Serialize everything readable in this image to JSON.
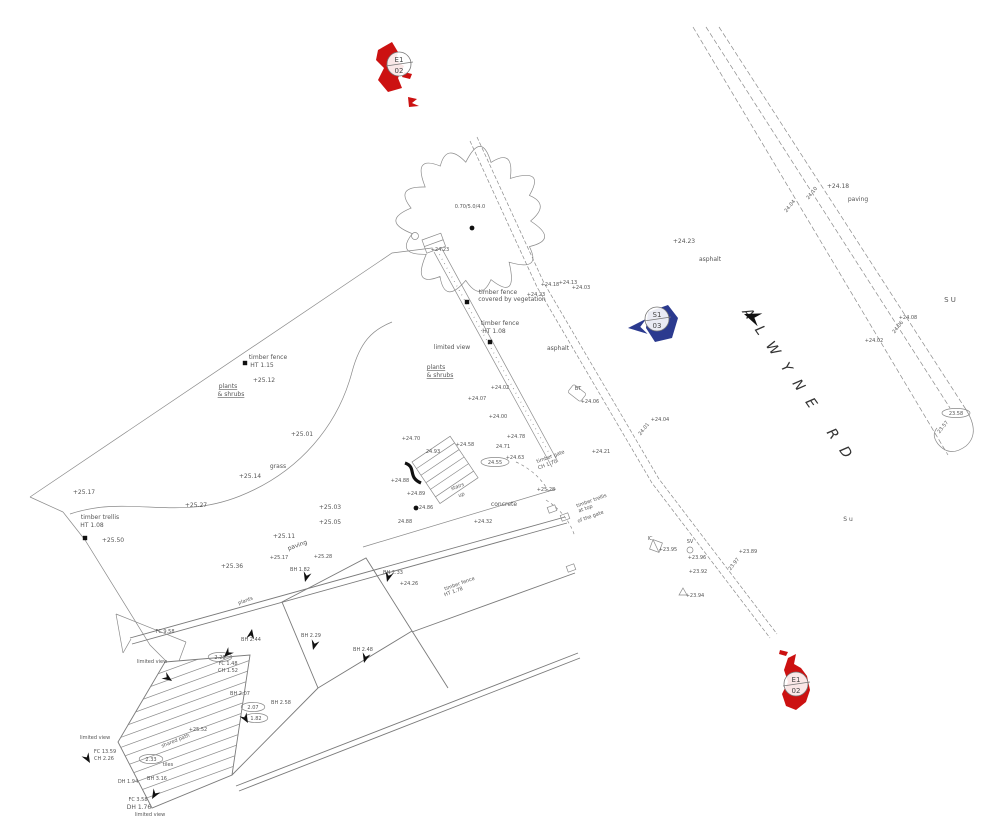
{
  "colors": {
    "station_red": "#cc1111",
    "station_blue": "#2b3a8f",
    "line": "#8a8a8a",
    "text": "#555555"
  },
  "road": {
    "name": "ALWYNE RD"
  },
  "tree": {
    "label": "0.70/5.0/4.0"
  },
  "markers": [
    {
      "id": "station-E1-02-top",
      "line1": "E1",
      "line2": "02",
      "color": "#cc1111",
      "cx": 399,
      "cy": 64
    },
    {
      "id": "station-S1-03",
      "line1": "S1",
      "line2": "03",
      "color": "#2b3a8f",
      "cx": 657,
      "cy": 319
    },
    {
      "id": "station-E1-02-bottom",
      "line1": "E1",
      "line2": "02",
      "color": "#cc1111",
      "cx": 796,
      "cy": 684
    }
  ],
  "ovals": [
    {
      "t": "2.28",
      "x": 220,
      "y": 657
    },
    {
      "t": "2.07",
      "x": 253,
      "y": 707
    },
    {
      "t": "1.82",
      "x": 256,
      "y": 718
    },
    {
      "t": "2.33",
      "x": 151,
      "y": 759
    },
    {
      "t": "24.55",
      "x": 495,
      "y": 462
    },
    {
      "t": "23.58",
      "x": 956,
      "y": 413
    }
  ],
  "posts": [
    {
      "x": 467,
      "y": 302
    },
    {
      "x": 490,
      "y": 342
    },
    {
      "x": 85,
      "y": 538
    },
    {
      "x": 245,
      "y": 363
    }
  ],
  "dots": [
    {
      "x": 416,
      "y": 508
    },
    {
      "x": 472,
      "y": 228
    }
  ],
  "arrows": [
    {
      "x": 252,
      "y": 629,
      "r": -80
    },
    {
      "x": 305,
      "y": 582,
      "r": 105
    },
    {
      "x": 313,
      "y": 650,
      "r": 105
    },
    {
      "x": 364,
      "y": 663,
      "r": 105
    },
    {
      "x": 387,
      "y": 582,
      "r": 105
    },
    {
      "x": 172,
      "y": 681,
      "r": 35
    },
    {
      "x": 224,
      "y": 657,
      "r": 135
    },
    {
      "x": 248,
      "y": 723,
      "r": 60
    },
    {
      "x": 152,
      "y": 799,
      "r": 120
    },
    {
      "x": 90,
      "y": 763,
      "r": 60
    },
    {
      "x": 744,
      "y": 314,
      "r": 200,
      "s": 1.7
    },
    {
      "x": 628,
      "y": 328,
      "r": 175,
      "s": 1.9,
      "c": "#2b3a8f"
    }
  ],
  "labels": [
    {
      "t": "+25.17",
      "x": 84,
      "y": 494
    },
    {
      "t": "+25.27",
      "x": 196,
      "y": 507
    },
    {
      "t": "timber trellis",
      "x": 100,
      "y": 519
    },
    {
      "t": "HT 1.08",
      "x": 92,
      "y": 527
    },
    {
      "t": "+25.50",
      "x": 113,
      "y": 542
    },
    {
      "t": "+25.36",
      "x": 232,
      "y": 568
    },
    {
      "t": "timber fence",
      "x": 268,
      "y": 359
    },
    {
      "t": "HT 1.15",
      "x": 262,
      "y": 367
    },
    {
      "t": "+25.12",
      "x": 264,
      "y": 382
    },
    {
      "t": "plants",
      "x": 228,
      "y": 388,
      "u": 1
    },
    {
      "t": "& shrubs",
      "x": 231,
      "y": 396,
      "u": 1
    },
    {
      "t": "grass",
      "x": 278,
      "y": 468
    },
    {
      "t": "+25.14",
      "x": 250,
      "y": 478
    },
    {
      "t": "+25.01",
      "x": 302,
      "y": 436
    },
    {
      "t": "+25.11",
      "x": 284,
      "y": 538
    },
    {
      "t": "+25.03",
      "x": 330,
      "y": 509
    },
    {
      "t": "+25.05",
      "x": 330,
      "y": 524
    },
    {
      "t": "+24.23",
      "x": 440,
      "y": 251,
      "s": 5
    },
    {
      "t": "timber fence",
      "x": 498,
      "y": 294
    },
    {
      "t": "covered by vegetation",
      "x": 512,
      "y": 301
    },
    {
      "t": "+24.23",
      "x": 536,
      "y": 296,
      "s": 5
    },
    {
      "t": "+24.18",
      "x": 550,
      "y": 286,
      "s": 5
    },
    {
      "t": "+24.13",
      "x": 568,
      "y": 284,
      "s": 5
    },
    {
      "t": "+24.03",
      "x": 581,
      "y": 289,
      "s": 5
    },
    {
      "t": "timber fence",
      "x": 500,
      "y": 325
    },
    {
      "t": "HT 1.08",
      "x": 494,
      "y": 333
    },
    {
      "t": "limited view",
      "x": 452,
      "y": 349
    },
    {
      "t": "asphalt",
      "x": 558,
      "y": 350
    },
    {
      "t": "plants",
      "x": 436,
      "y": 369,
      "u": 1
    },
    {
      "t": "& shrubs",
      "x": 440,
      "y": 377,
      "u": 1
    },
    {
      "t": "+24.02",
      "x": 500,
      "y": 389,
      "s": 5
    },
    {
      "t": "+24.07",
      "x": 477,
      "y": 400,
      "s": 5
    },
    {
      "t": "+24.00",
      "x": 498,
      "y": 418,
      "s": 5
    },
    {
      "t": "+24.23",
      "x": 684,
      "y": 243
    },
    {
      "t": "asphalt",
      "x": 710,
      "y": 261
    },
    {
      "t": "+24.18",
      "x": 838,
      "y": 188
    },
    {
      "t": "paving",
      "x": 858,
      "y": 201
    },
    {
      "t": "24.10",
      "x": 813,
      "y": 194,
      "r": -52,
      "s": 5
    },
    {
      "t": "24.04",
      "x": 791,
      "y": 207,
      "r": -52,
      "s": 5
    },
    {
      "t": "+24.08",
      "x": 908,
      "y": 319,
      "s": 5
    },
    {
      "t": "24.06",
      "x": 899,
      "y": 328,
      "r": -52,
      "s": 5
    },
    {
      "t": "+24.02",
      "x": 874,
      "y": 342,
      "s": 5
    },
    {
      "t": "S U",
      "x": 950,
      "y": 302,
      "s": 7
    },
    {
      "t": "S u",
      "x": 848,
      "y": 521
    },
    {
      "t": "23.57",
      "x": 944,
      "y": 428,
      "r": -52,
      "s": 5
    },
    {
      "t": "BT",
      "x": 578,
      "y": 390,
      "s": 5
    },
    {
      "t": "+24.06",
      "x": 590,
      "y": 403,
      "s": 5
    },
    {
      "t": "+24.04",
      "x": 660,
      "y": 421,
      "s": 5
    },
    {
      "t": "24.01",
      "x": 645,
      "y": 430,
      "r": -52,
      "s": 5
    },
    {
      "t": "+24.21",
      "x": 601,
      "y": 453,
      "s": 5
    },
    {
      "t": "IC",
      "x": 650,
      "y": 540,
      "s": 5
    },
    {
      "t": "+23.95",
      "x": 668,
      "y": 551,
      "s": 5
    },
    {
      "t": "SV",
      "x": 690,
      "y": 543,
      "s": 5
    },
    {
      "t": "+23.96",
      "x": 697,
      "y": 559,
      "s": 5
    },
    {
      "t": "+23.89",
      "x": 748,
      "y": 553,
      "s": 5
    },
    {
      "t": "23.97",
      "x": 735,
      "y": 565,
      "r": -52,
      "s": 5
    },
    {
      "t": "+23.92",
      "x": 698,
      "y": 573,
      "s": 5
    },
    {
      "t": "+23.94",
      "x": 695,
      "y": 597,
      "s": 5
    },
    {
      "t": "+24.70",
      "x": 411,
      "y": 440,
      "s": 5
    },
    {
      "t": "+24.58",
      "x": 465,
      "y": 446,
      "s": 5
    },
    {
      "t": "24.93",
      "x": 433,
      "y": 453,
      "s": 5
    },
    {
      "t": "+24.78",
      "x": 516,
      "y": 438,
      "s": 5
    },
    {
      "t": "24.71",
      "x": 503,
      "y": 448,
      "s": 5
    },
    {
      "t": "+24.63",
      "x": 515,
      "y": 459,
      "s": 5
    },
    {
      "t": "timber gate",
      "x": 551,
      "y": 458,
      "r": -20,
      "s": 5
    },
    {
      "t": "CH 1.70",
      "x": 548,
      "y": 466,
      "r": -20,
      "s": 5
    },
    {
      "t": "stairs",
      "x": 458,
      "y": 488,
      "r": -20,
      "s": 5
    },
    {
      "t": "up",
      "x": 462,
      "y": 496,
      "r": -20,
      "s": 5
    },
    {
      "t": "+24.88",
      "x": 400,
      "y": 482,
      "s": 5
    },
    {
      "t": "+24.89",
      "x": 416,
      "y": 495,
      "s": 5
    },
    {
      "t": "+24.86",
      "x": 424,
      "y": 509,
      "s": 5
    },
    {
      "t": "24.88",
      "x": 405,
      "y": 523,
      "s": 5
    },
    {
      "t": "concrete",
      "x": 504,
      "y": 506
    },
    {
      "t": "+24.32",
      "x": 483,
      "y": 523,
      "s": 5
    },
    {
      "t": "+25.28",
      "x": 546,
      "y": 491,
      "s": 5
    },
    {
      "t": "timber trellis",
      "x": 592,
      "y": 502,
      "r": -20,
      "s": 5
    },
    {
      "t": "at top",
      "x": 586,
      "y": 510,
      "r": -20,
      "s": 5
    },
    {
      "t": "of the gate",
      "x": 591,
      "y": 518,
      "r": -20,
      "s": 5
    },
    {
      "t": "paving",
      "x": 298,
      "y": 547,
      "r": -20
    },
    {
      "t": "+25.17",
      "x": 279,
      "y": 559,
      "s": 5
    },
    {
      "t": "+25.28",
      "x": 323,
      "y": 558,
      "s": 5
    },
    {
      "t": "BH 1.82",
      "x": 300,
      "y": 571,
      "s": 5
    },
    {
      "t": "BH 2.33",
      "x": 393,
      "y": 574,
      "s": 5
    },
    {
      "t": "+24.26",
      "x": 409,
      "y": 585,
      "s": 5
    },
    {
      "t": "timber fence",
      "x": 460,
      "y": 585,
      "r": -20,
      "s": 5
    },
    {
      "t": "HT 1.78",
      "x": 454,
      "y": 593,
      "r": -20,
      "s": 5
    },
    {
      "t": "plants",
      "x": 246,
      "y": 602,
      "r": -20,
      "s": 5
    },
    {
      "t": "BH 2.29",
      "x": 311,
      "y": 637,
      "s": 5
    },
    {
      "t": "BH 2.48",
      "x": 363,
      "y": 651,
      "s": 5
    },
    {
      "t": "BH 2.44",
      "x": 251,
      "y": 641,
      "s": 5
    },
    {
      "t": "FC 9.58",
      "x": 165,
      "y": 633,
      "s": 5
    },
    {
      "t": "limited view",
      "x": 152,
      "y": 663,
      "s": 5
    },
    {
      "t": "FC 1.48",
      "x": 228,
      "y": 665,
      "s": 5
    },
    {
      "t": "CH 1.52",
      "x": 228,
      "y": 672,
      "s": 5
    },
    {
      "t": "BH 2.07",
      "x": 240,
      "y": 695,
      "s": 5
    },
    {
      "t": "BH 2.58",
      "x": 281,
      "y": 704,
      "s": 5
    },
    {
      "t": "shared path",
      "x": 176,
      "y": 742,
      "r": -22,
      "s": 5
    },
    {
      "t": "+25.52",
      "x": 198,
      "y": 731,
      "s": 5
    },
    {
      "t": "limited view",
      "x": 95,
      "y": 739,
      "s": 5
    },
    {
      "t": "FC 13.59",
      "x": 105,
      "y": 753,
      "s": 5
    },
    {
      "t": "CH 2.26",
      "x": 104,
      "y": 760,
      "s": 5
    },
    {
      "t": "tiles",
      "x": 168,
      "y": 766,
      "s": 5
    },
    {
      "t": "DH 1.94",
      "x": 128,
      "y": 783,
      "s": 5
    },
    {
      "t": "BH 3.16",
      "x": 157,
      "y": 780,
      "s": 5
    },
    {
      "t": "FC 3.58",
      "x": 138,
      "y": 801,
      "s": 5
    },
    {
      "t": "DH 1.76",
      "x": 139,
      "y": 809
    },
    {
      "t": "limited view",
      "x": 150,
      "y": 816,
      "s": 5
    }
  ]
}
